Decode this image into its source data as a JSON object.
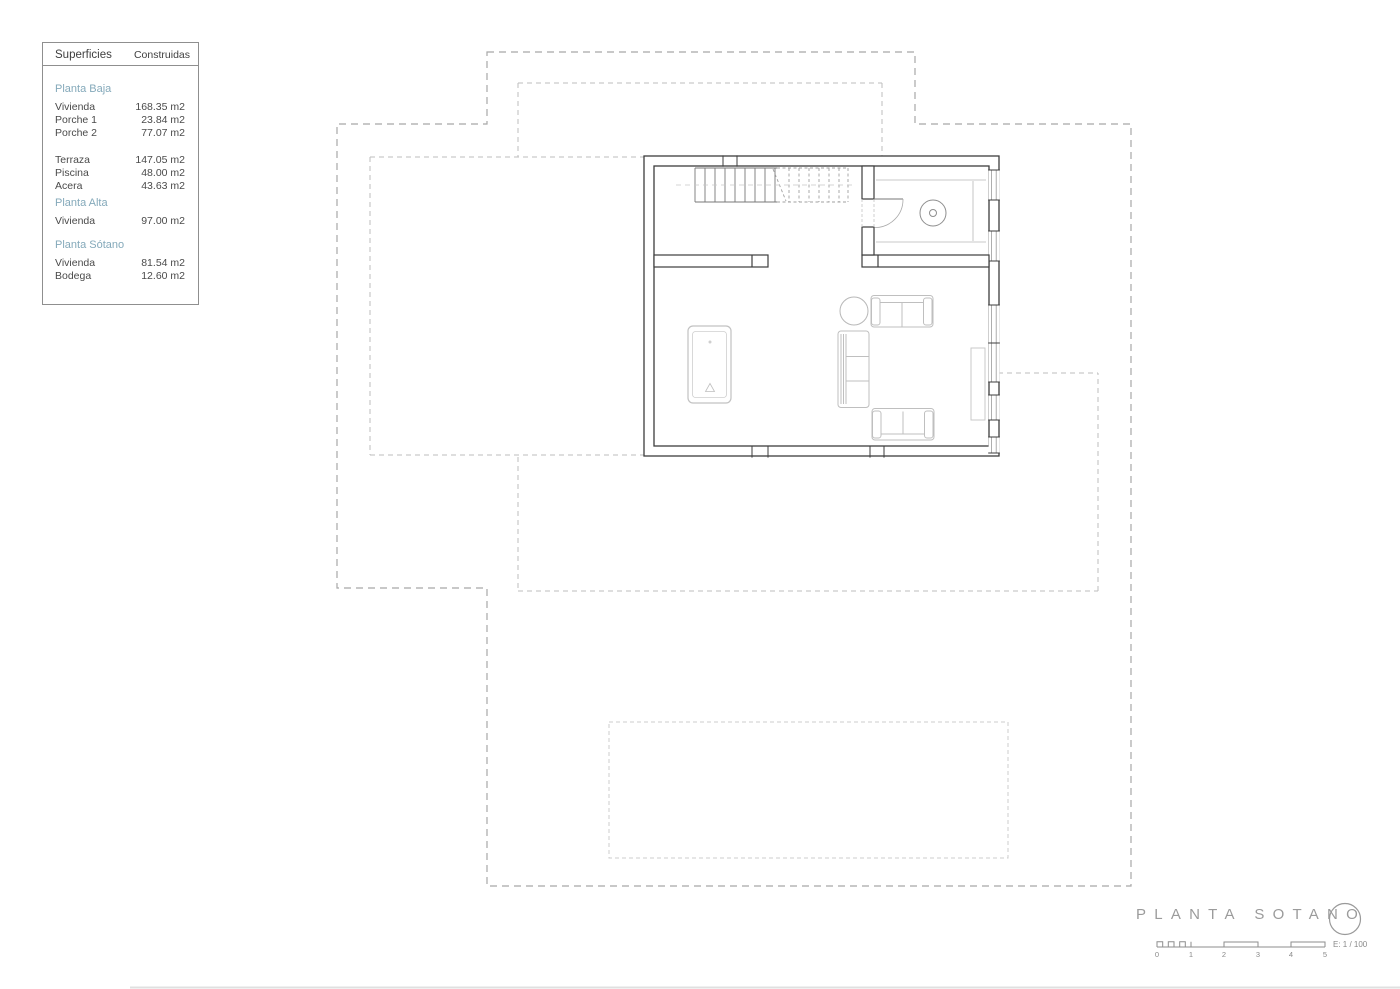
{
  "legend": {
    "header_col1": "Superficies",
    "header_col2": "Construidas",
    "accent_color": "#84a9ba",
    "sections": [
      {
        "title": "Planta Baja",
        "rows": [
          {
            "label": "Vivienda",
            "value": "168.35 m2"
          },
          {
            "label": "Porche 1",
            "value": "23.84 m2"
          },
          {
            "label": "Porche 2",
            "value": "77.07 m2"
          }
        ]
      },
      {
        "title": "",
        "rows": [
          {
            "label": "Terraza",
            "value": "147.05 m2"
          },
          {
            "label": "Piscina",
            "value": "48.00 m2"
          },
          {
            "label": "Acera",
            "value": "43.63 m2"
          }
        ]
      },
      {
        "title": "Planta Alta",
        "rows": [
          {
            "label": "Vivienda",
            "value": "97.00 m2"
          }
        ]
      },
      {
        "title": "Planta Sótano",
        "rows": [
          {
            "label": "Vivienda",
            "value": "81.54 m2"
          },
          {
            "label": "Bodega",
            "value": "12.60 m2"
          }
        ]
      }
    ]
  },
  "title_block": {
    "title": "PLANTA SOTANO",
    "scale_label": "E: 1 / 100",
    "scale_ticks": [
      "0",
      "1",
      "2",
      "3",
      "4",
      "5"
    ]
  }
}
